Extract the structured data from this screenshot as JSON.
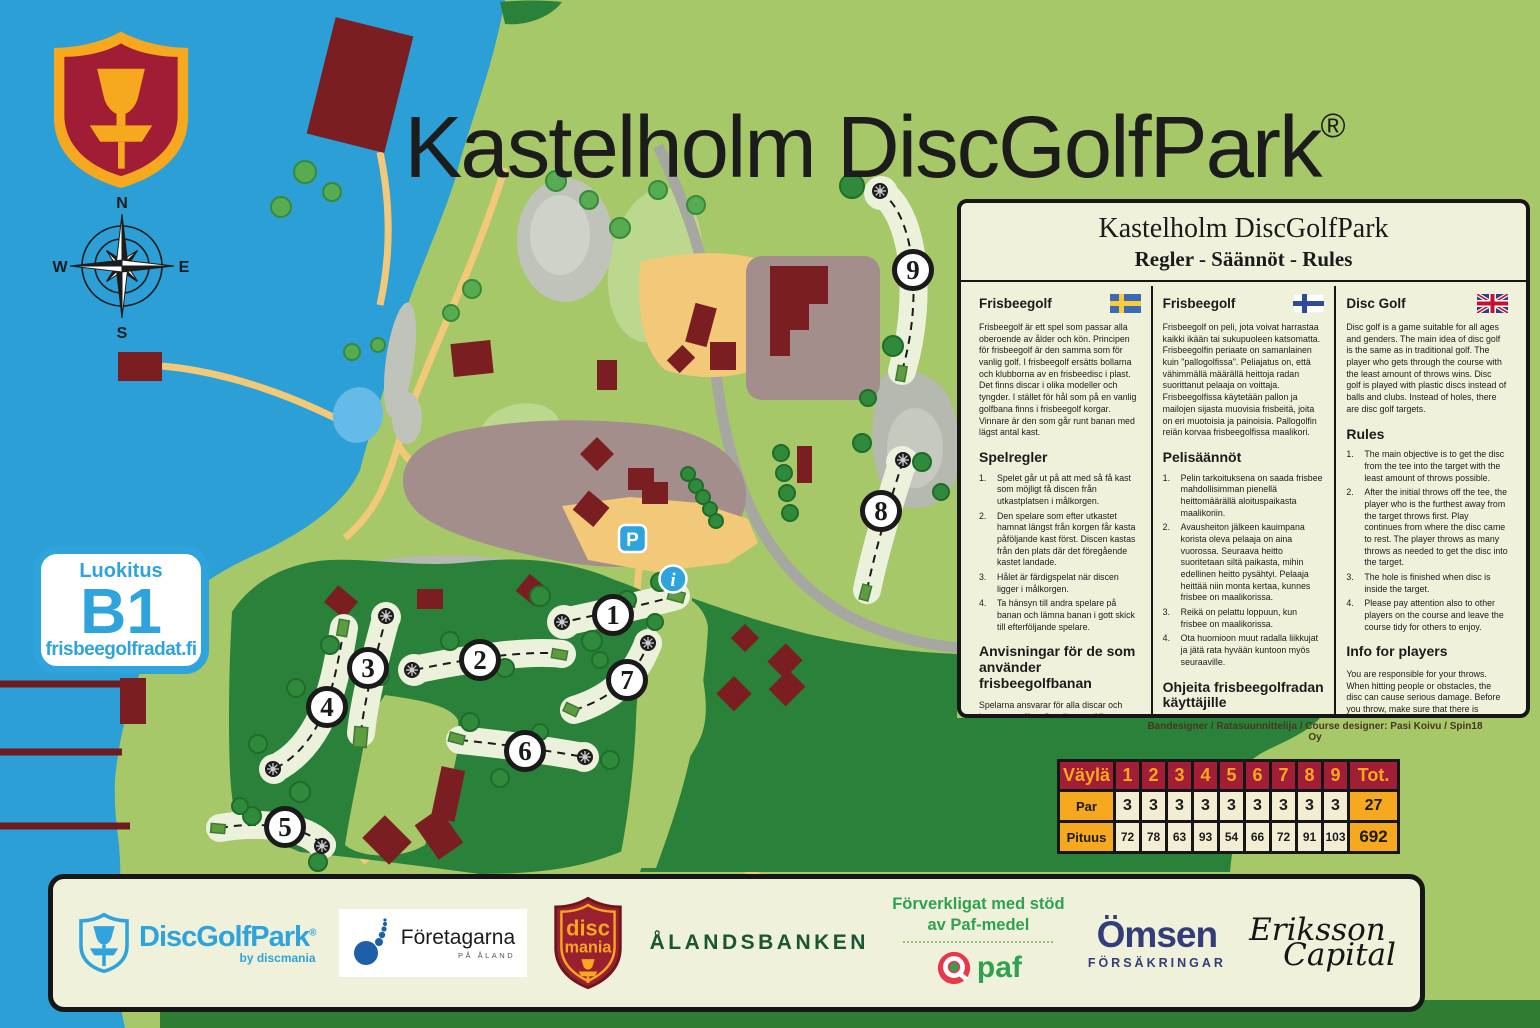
{
  "title": "Kastelholm DiscGolfPark",
  "registered_mark": "®",
  "compass": {
    "n": "N",
    "e": "E",
    "s": "S",
    "w": "W"
  },
  "rating_badge": {
    "label": "Luokitus",
    "rating": "B1",
    "website": "frisbeegolfradat.fi"
  },
  "map": {
    "parking_label": "P",
    "info_label": "i",
    "holes": [
      {
        "number": "1"
      },
      {
        "number": "2"
      },
      {
        "number": "3"
      },
      {
        "number": "4"
      },
      {
        "number": "5"
      },
      {
        "number": "6"
      },
      {
        "number": "7"
      },
      {
        "number": "8"
      },
      {
        "number": "9"
      }
    ]
  },
  "colors": {
    "accent_blue": "#2FA3DC",
    "crimson": "#A21E36",
    "gold": "#F6A81E",
    "forest": "#2A8139",
    "water": "#2B9FD6"
  },
  "rules_panel": {
    "title": "Kastelholm DiscGolfPark",
    "subtitle": "Regler - Säännöt - Rules",
    "credit": "Bandesigner / Ratasuunnittelija / Course designer: Pasi Koivu / Spin18 Oy",
    "columns": [
      {
        "heading": "Frisbeegolf",
        "flag": "sweden",
        "intro": "Frisbeegolf är ett spel som passar alla oberoende av ålder och kön. Principen för frisbeegolf är den samma som för vanlig golf. I frisbeegolf ersätts bollarna och klubborna av en frisbeedisc i plast. Det finns discar i olika modeller och tyngder. I stället för hål som på en vanlig golfbana finns i frisbeegolf korgar. Vinnare är den som går runt banan med lägst antal kast.",
        "rules_heading": "Spelregler",
        "rules": [
          "Spelet går ut på att med så få kast som möjligt få discen från utkastplatsen i målkorgen.",
          "Den spelare som efter utkastet hamnat längst från korgen får kasta påföljande kast först. Discen kastas från den plats där det föregående kastet landade.",
          "Hålet är färdigspelat när discen ligger i målkorgen.",
          "Ta hänsyn till andra spelare på banan och lämna banan i gott skick till efterföljande spelare."
        ],
        "guide_heading": "Anvisningar för de som använder frisbeegolfbanan",
        "guide": "Spelarna ansvarar för alla discar och kast som utförs. Om discen träffar en människa eller ett föremål kan den förorsaka allvarlig skada.",
        "tips_heading": "Att beakta före ett kast",
        "tips": [
          "- Kasta inte förrän du ser korgen och försäkra dig alltid om att ingen står framför korgen.",
          "- Kasta inte om föregående grupp ännu puttar vid korgen."
        ],
        "par_line": "Banans par (idealresultat) är 27 kast."
      },
      {
        "heading": "Frisbeegolf",
        "flag": "finland",
        "intro": "Frisbeegolf on peli, jota voivat harrastaa kaikki ikään tai sukupuoleen katsomatta. Frisbeegolfin periaate on samanlainen kuin \"pallogolfissa\". Peliajatus on, että vähimmällä määrällä heittoja radan suorittanut pelaaja on voittaja. Frisbeegolfissa käytetään pallon ja mailojen sijasta muovisia frisbeitä, joita on eri muotoisia ja painoisia. Pallogolfin reiän korvaa frisbeegolfissa maalikori.",
        "rules_heading": "Pelisäännöt",
        "rules": [
          "Pelin tarkoituksena on saada frisbee mahdollisimman pienellä heittomäärällä aloituspaikasta maalikoriin.",
          "Avausheiton jälkeen kauimpana korista oleva pelaaja on aina vuorossa. Seuraava heitto suoritetaan siltä paikasta, mihin edellinen heitto pysähtyi. Pelaaja heittää niin monta kertaa, kunnes frisbee on maalikorissa.",
          "Reikä on pelattu loppuun, kun frisbee on maalikorissa.",
          "Ota huomioon muut radalla liikkujat ja jätä rata hyvään kuntoon myös seuraaville."
        ],
        "guide_heading": "Ohjeita frisbeegolfradan käyttäjille",
        "guide": "Olet vastuussa jokaisesta heittämästäsi kiekosta. Osuessaan ihmisiin tai esineisiin kiekko voi aiheuttaa vakavaa vahinkoa. Varmista aina ennen heittoa, ettei väylillä liiku ketään.",
        "tips_heading": "Heittäminen kierroksella",
        "tips": [
          "- Älä heitä, jos koria ei näy, vaan varmista ensin onko korilla ketään edessä.",
          "- Älä heitä, jos kiekko on vaarassa osua lähistöllä oleviin ihmisiin tai eläimiin."
        ],
        "par_line": "Radan par (ihannetulos) on 27 heittoa."
      },
      {
        "heading": "Disc Golf",
        "flag": "uk",
        "intro": "Disc golf is a game suitable for all ages and genders. The main idea of disc golf is the same as in traditional golf. The player who gets through the course with the least amount of throws wins. Disc golf is played with plastic discs instead of balls and clubs. Instead of holes, there are disc golf targets.",
        "rules_heading": "Rules",
        "rules": [
          "The main objective is to get the disc from the tee into the target with the least amount of throws possible.",
          "After the initial throws off the tee, the player who is the furthest away from the target throws first. Play continues from where the disc came to rest. The player throws as many throws as needed to get the disc into the target.",
          "The hole is finished when disc is inside the target.",
          "Please pay attention also to other players on the course and leave the course tidy for others to enjoy."
        ],
        "guide_heading": "Info for players",
        "guide": "You are responsible for your throws. When hitting people or obstacles, the disc can cause serious damage. Before you throw, make sure that there is nobody in the near the direction of your throw.",
        "tips_heading": "Throwing during round",
        "tips": [
          "- Don't throw, if you can't see the target. Make sure the hole is clear before you throw.",
          "- Don't throw if there's even a possibility of hitting people or animals."
        ],
        "par_line": "Course par (ideal result) is 27 throws."
      }
    ]
  },
  "score_table": {
    "header": [
      "Väylä",
      "1",
      "2",
      "3",
      "4",
      "5",
      "6",
      "7",
      "8",
      "9",
      "Tot."
    ],
    "rows": [
      {
        "label": "Par",
        "values": [
          "3",
          "3",
          "3",
          "3",
          "3",
          "3",
          "3",
          "3",
          "3"
        ],
        "total": "27"
      },
      {
        "label": "Pituus",
        "values": [
          "72",
          "78",
          "63",
          "93",
          "54",
          "66",
          "72",
          "91",
          "103"
        ],
        "total": "692"
      }
    ]
  },
  "sponsors": {
    "discgolfpark": {
      "name": "DiscGolfPark",
      "registered": "®",
      "sub": "by discmania"
    },
    "foretagarna": {
      "name": "Företagarna",
      "sub": "PÅ ÅLAND"
    },
    "discmania": {
      "line1": "disc",
      "line2": "mania"
    },
    "alandsbanken": {
      "name": "ÅLANDSBANKEN"
    },
    "paf": {
      "support_line1": "Förverkligat med stöd",
      "support_line2": "av Paf-medel",
      "logo_text": "paf"
    },
    "omsen": {
      "name": "Ömsen",
      "sub": "FÖRSÄKRINGAR"
    },
    "eriksson": {
      "line1": "Eriksson",
      "line2": "Capital"
    }
  }
}
